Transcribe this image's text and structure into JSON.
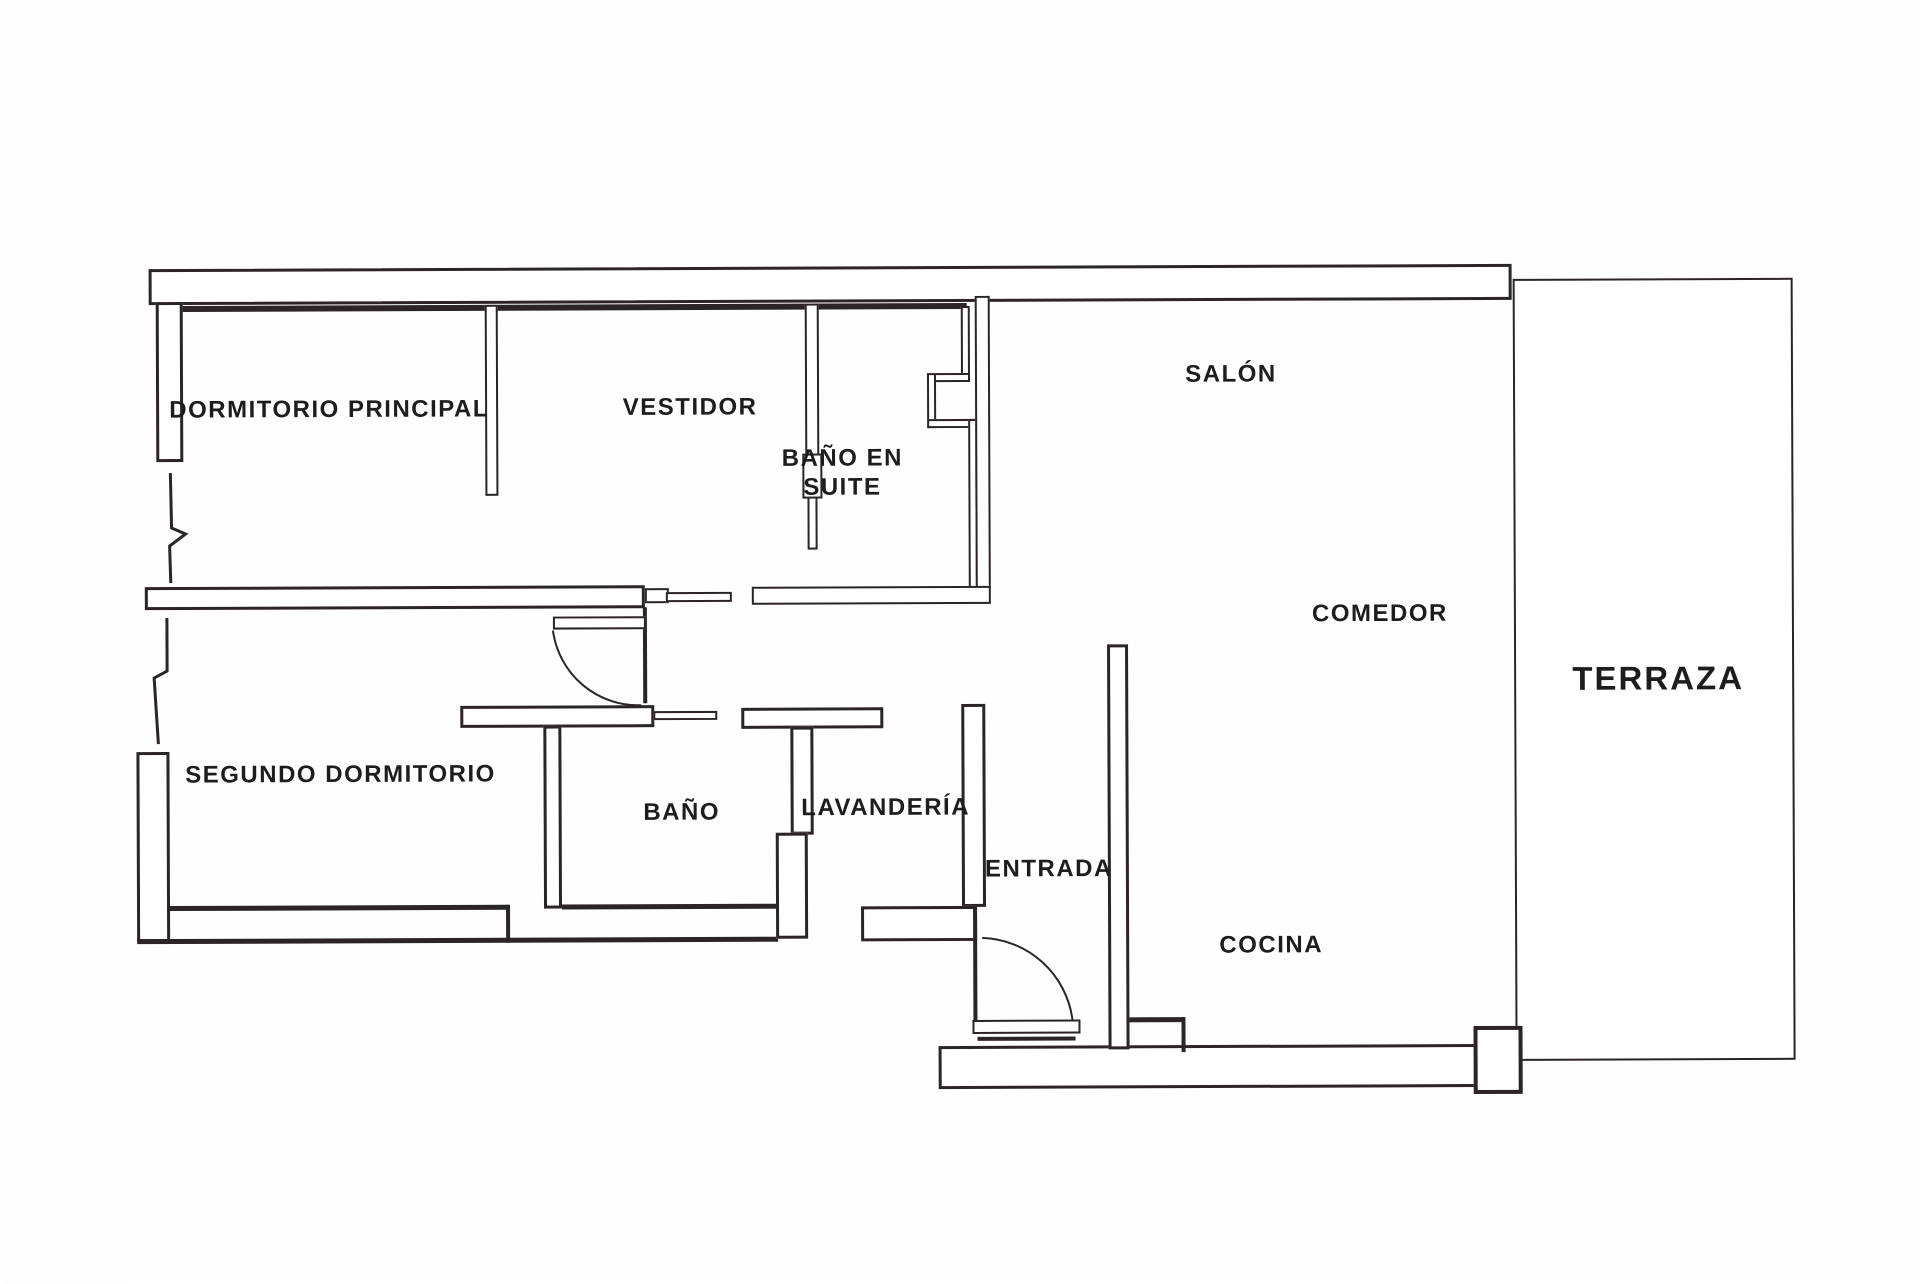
{
  "plan_title": "Floor plan",
  "rooms": {
    "dormitorio_principal": "DORMITORIO PRINCIPAL",
    "vestidor": "VESTIDOR",
    "bano_en_suite": "BAÑO EN SUITE",
    "salon": "SALÓN",
    "comedor": "COMEDOR",
    "terraza": "TERRAZA",
    "segundo_dormitorio": "SEGUNDO DORMITORIO",
    "bano": "BAÑO",
    "lavanderia": "LAVANDERÍA",
    "entrada": "ENTRADA",
    "cocina": "COCINA"
  },
  "colors": {
    "wall_line": "#2b2527",
    "background": "#fefefe",
    "text": "#1d1d1d"
  }
}
